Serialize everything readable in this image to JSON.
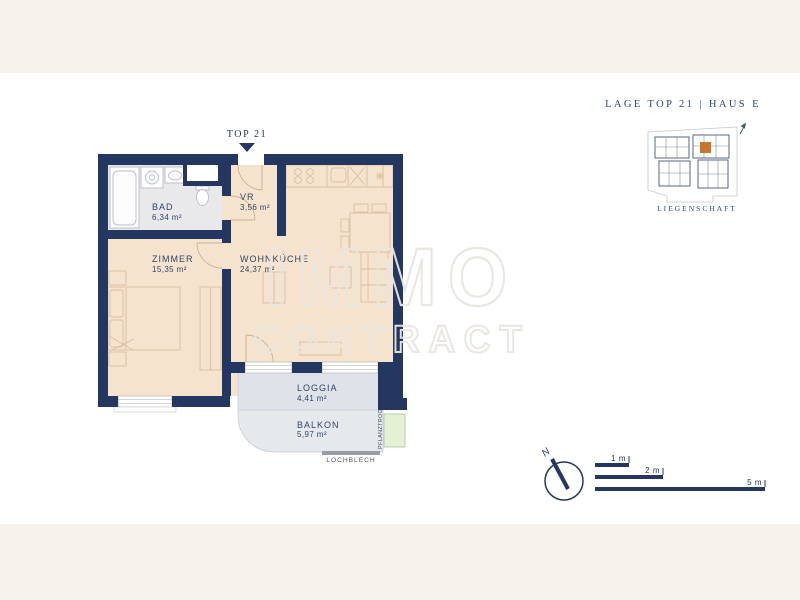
{
  "header": {
    "label": "LAGE TOP 21  |  HAUS E"
  },
  "unit_marker": {
    "label": "TOP 21"
  },
  "rooms": {
    "bad": {
      "name": "BAD",
      "area": "6,34 m²"
    },
    "vr": {
      "name": "VR",
      "area": "3,56 m²"
    },
    "zimmer": {
      "name": "ZIMMER",
      "area": "15,35 m²"
    },
    "wohnkueche": {
      "name": "WOHNKÜCHE",
      "area": "24,37 m²"
    },
    "loggia": {
      "name": "LOGGIA",
      "area": "4,41 m²"
    },
    "balkon": {
      "name": "BALKON",
      "area": "5,97 m²"
    }
  },
  "annotations": {
    "lochblech": "LOCHBLECH",
    "pflanztrog": "PFLANZTROG"
  },
  "site_plan": {
    "caption": "LIEGENSCHAFT"
  },
  "compass": {
    "north": "N"
  },
  "scale_bar": {
    "m1": "1 m",
    "m2": "2 m",
    "m5": "5 m"
  },
  "watermark": {
    "line1": "IMMO",
    "line2": "CONTRACT"
  },
  "colors": {
    "wall_navy": "#243761",
    "floor_beige": "#f6e3cd",
    "floor_gray": "#e9e8ea",
    "loggia_gray": "#dfe3e9",
    "balcony_gray": "#e6e9ec",
    "planter_green": "#e4f1d5",
    "accent_orange": "#c8762e",
    "background_cream": "#f7f3ec",
    "canvas_white": "#ffffff"
  }
}
